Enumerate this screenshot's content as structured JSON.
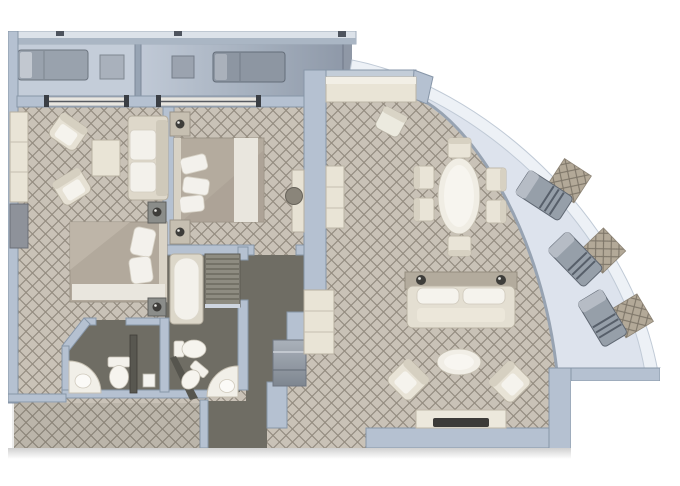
{
  "description": "Overhead architectural floor plan of a two-bedroom suite with wrap-around curved balcony (no text labels rendered in image)",
  "palette": {
    "background": "#ffffff",
    "wall": "#b5c1d1",
    "wall_edge": "#8796a8",
    "wall_light": "#dce2e9",
    "carpet_base": "#c9c2b7",
    "carpet_lattice": "#948c80",
    "bath_floor": "#6f6d64",
    "balcony_floor": "#c4cdd9",
    "balcony_shadow": "#8b95a5",
    "curved_balcony_floor": "#dde3ed",
    "balcony_rim": "#edf1f6",
    "furniture_cream": "#e9e4d6",
    "furniture_white": "#f5f3ed",
    "lounger_gray": "#969fa9",
    "dark_fixture": "#3e3d3a"
  },
  "rooms": {
    "balcony_top_left": {
      "name": "private balcony 1",
      "furniture": [
        "sun lounger",
        "side table"
      ]
    },
    "balcony_top_right": {
      "name": "private balcony 2",
      "furniture": [
        "side table",
        "sun lounger"
      ]
    },
    "bedroom_second": {
      "name": "second bedroom",
      "furniture": [
        "wardrobe",
        "armchair",
        "armchair",
        "side table",
        "sofa",
        "double bed",
        "nightstand with lamp",
        "nightstand with lamp"
      ]
    },
    "bedroom_master": {
      "name": "master bedroom",
      "furniture": [
        "double bed",
        "nightstand with lamp",
        "nightstand with lamp",
        "vanity desk",
        "stool"
      ]
    },
    "bathroom_guest": {
      "name": "guest bathroom",
      "furniture": [
        "corner washbasin",
        "toilet"
      ]
    },
    "bathroom_master": {
      "name": "master bathroom",
      "furniture": [
        "bathtub",
        "shower",
        "bidet",
        "toilet",
        "corner washbasin"
      ]
    },
    "living_room": {
      "name": "living / dining room",
      "furniture": [
        "window counter desk",
        "desk chair",
        "sideboard",
        "oval dining table",
        "dining chair x6",
        "tall cabinet",
        "sofa with console lamps",
        "oval coffee table",
        "armchair",
        "armchair",
        "tv console",
        "television"
      ]
    },
    "corridor": {
      "name": "entry corridor and closets",
      "furniture": [
        "open closet"
      ]
    },
    "balcony_curved": {
      "name": "curved wrap-around balcony",
      "furniture": [
        "sun lounger with mat",
        "sun lounger with mat",
        "sun lounger with mat"
      ]
    }
  }
}
